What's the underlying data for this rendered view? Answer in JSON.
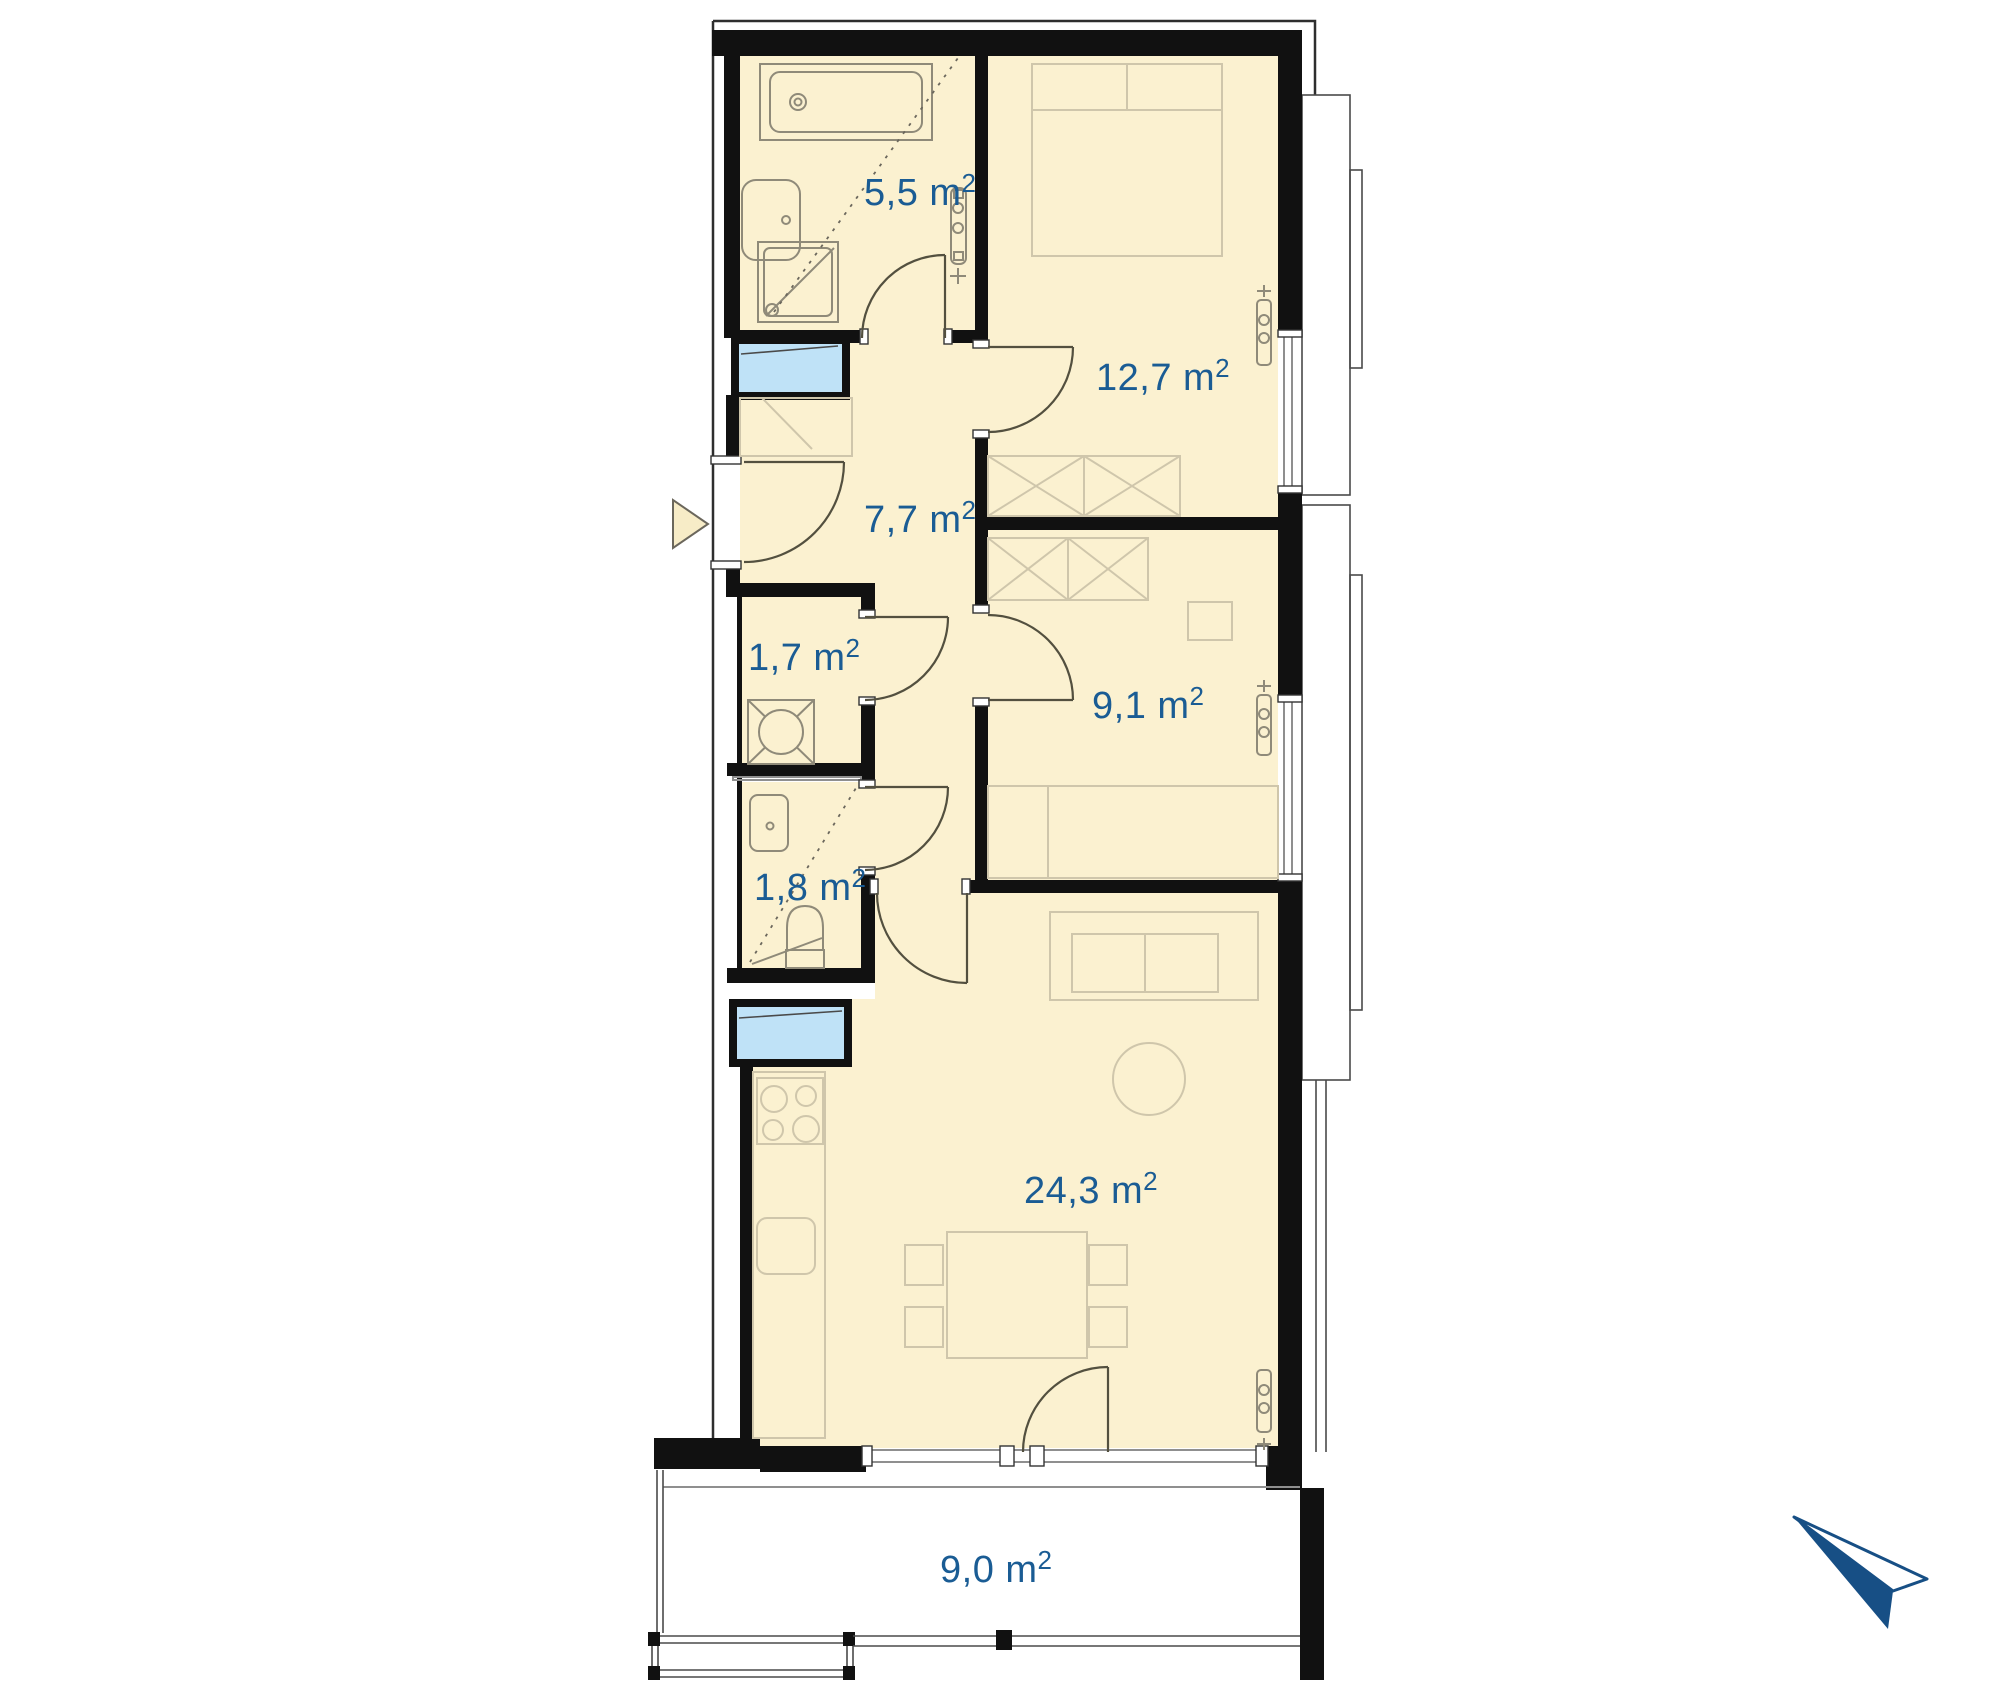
{
  "title": "apartment-floor-plan",
  "rooms": [
    {
      "name": "bathroom",
      "label": "5,5 m",
      "sup": "2"
    },
    {
      "name": "bedroom-large",
      "label": "12,7 m",
      "sup": "2"
    },
    {
      "name": "hallway",
      "label": "7,7 m",
      "sup": "2"
    },
    {
      "name": "storage",
      "label": "1,7 m",
      "sup": "2"
    },
    {
      "name": "bedroom-small",
      "label": "9,1 m",
      "sup": "2"
    },
    {
      "name": "wc",
      "label": "1,8 m",
      "sup": "2"
    },
    {
      "name": "living-kitchen",
      "label": "24,3 m",
      "sup": "2"
    },
    {
      "name": "balcony",
      "label": "9,0 m",
      "sup": "2"
    }
  ],
  "icons": {
    "entrance_marker": "triangle-right",
    "logo": "paper-plane"
  },
  "colors": {
    "room_fill": "#fbf1d0",
    "wall": "#111111",
    "label_blue": "#1a5c94",
    "shaft_fill": "#bfe2f7",
    "logo_navy": "#174f85",
    "furniture_line": "#cfc6ab",
    "fixture_line": "#8f8a79",
    "window_line": "#8f8f8f"
  }
}
